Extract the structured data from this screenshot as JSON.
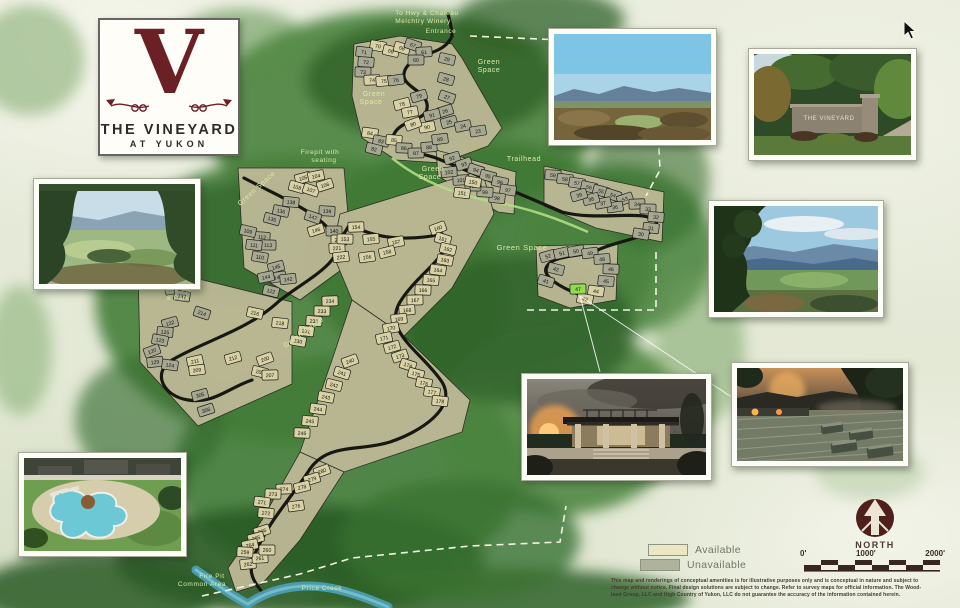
{
  "logo": {
    "letter": "V",
    "line1": "THE VINEYARD",
    "line2": "AT YUKON"
  },
  "photos": {
    "entrance_sign_text": "THE VINEYARD"
  },
  "map": {
    "labels": [
      {
        "t": "To Hwy & Chateau",
        "x": 427,
        "y": 15,
        "s": 6.5
      },
      {
        "t": "Melchtry Winery",
        "x": 423,
        "y": 23,
        "s": 6.5
      },
      {
        "t": "Entrance",
        "x": 441,
        "y": 33,
        "s": 6.5
      },
      {
        "t": "Green",
        "x": 489,
        "y": 64,
        "s": 7
      },
      {
        "t": "Space",
        "x": 489,
        "y": 72,
        "s": 7
      },
      {
        "t": "Green",
        "x": 374,
        "y": 96,
        "s": 7
      },
      {
        "t": "Space",
        "x": 371,
        "y": 104,
        "s": 7
      },
      {
        "t": "Firepit with",
        "x": 320,
        "y": 154,
        "s": 6.5
      },
      {
        "t": "seating",
        "x": 324,
        "y": 162,
        "s": 6.5
      },
      {
        "t": "Green",
        "x": 433,
        "y": 171,
        "s": 7
      },
      {
        "t": "Space",
        "x": 430,
        "y": 179,
        "s": 7
      },
      {
        "t": "Trailhead",
        "x": 524,
        "y": 161,
        "s": 7
      },
      {
        "t": "Green Space",
        "x": 522,
        "y": 250,
        "s": 7.5
      },
      {
        "t": "Green Space",
        "x": 258,
        "y": 190,
        "s": 7,
        "r": -42
      },
      {
        "t": "Green Space",
        "x": 305,
        "y": 334,
        "s": 7,
        "r": -36
      },
      {
        "t": "Fire Pit",
        "x": 178,
        "y": 292,
        "s": 6.5
      },
      {
        "t": "& Park",
        "x": 178,
        "y": 300,
        "s": 6.5
      },
      {
        "t": "Fire Pit",
        "x": 212,
        "y": 578,
        "s": 6.5
      },
      {
        "t": "Common Area",
        "x": 202,
        "y": 586,
        "s": 6.5
      },
      {
        "t": "Price Creek",
        "x": 322,
        "y": 590,
        "s": 6.5
      }
    ],
    "lot_colors": {
      "t": "#d8d1a6",
      "g": "#a7a892",
      "h": "#8fdc4e"
    },
    "lots": [
      [
        70,
        378,
        46,
        "t"
      ],
      [
        71,
        364,
        52,
        "g"
      ],
      [
        72,
        366,
        62,
        "g"
      ],
      [
        73,
        363,
        72,
        "g"
      ],
      [
        74,
        372,
        80,
        "t"
      ],
      [
        75,
        384,
        81,
        "t"
      ],
      [
        76,
        396,
        80,
        "g"
      ],
      [
        69,
        391,
        51,
        "t"
      ],
      [
        68,
        402,
        48,
        "t"
      ],
      [
        67,
        413,
        45,
        "g"
      ],
      [
        61,
        424,
        52,
        "g"
      ],
      [
        60,
        416,
        60,
        "g"
      ],
      [
        29,
        447,
        59,
        "g"
      ],
      [
        28,
        446,
        79,
        "g"
      ],
      [
        27,
        447,
        97,
        "g"
      ],
      [
        26,
        445,
        111,
        "g"
      ],
      [
        25,
        449,
        122,
        "g"
      ],
      [
        24,
        463,
        126,
        "g"
      ],
      [
        23,
        478,
        131,
        "g"
      ],
      [
        79,
        419,
        96,
        "g"
      ],
      [
        78,
        402,
        104,
        "t"
      ],
      [
        77,
        410,
        112,
        "t"
      ],
      [
        91,
        432,
        115,
        "g"
      ],
      [
        90,
        427,
        127,
        "t"
      ],
      [
        80,
        413,
        124,
        "t"
      ],
      [
        84,
        370,
        133,
        "t"
      ],
      [
        83,
        381,
        141,
        "g"
      ],
      [
        82,
        374,
        149,
        "g"
      ],
      [
        85,
        394,
        140,
        "t"
      ],
      [
        86,
        404,
        148,
        "g"
      ],
      [
        87,
        416,
        153,
        "g"
      ],
      [
        88,
        429,
        147,
        "g"
      ],
      [
        89,
        440,
        139,
        "g"
      ],
      [
        92,
        452,
        158,
        "g"
      ],
      [
        93,
        464,
        164,
        "g"
      ],
      [
        94,
        476,
        170,
        "g"
      ],
      [
        95,
        488,
        176,
        "g"
      ],
      [
        96,
        500,
        182,
        "g"
      ],
      [
        97,
        508,
        190,
        "g"
      ],
      [
        98,
        497,
        198,
        "g"
      ],
      [
        99,
        485,
        192,
        "g"
      ],
      [
        100,
        473,
        186,
        "g"
      ],
      [
        101,
        461,
        180,
        "g"
      ],
      [
        102,
        449,
        172,
        "g"
      ],
      [
        59,
        553,
        175,
        "g"
      ],
      [
        58,
        565,
        179,
        "g"
      ],
      [
        57,
        577,
        183,
        "g"
      ],
      [
        56,
        589,
        187,
        "g"
      ],
      [
        55,
        601,
        191,
        "g"
      ],
      [
        54,
        613,
        195,
        "g"
      ],
      [
        53,
        625,
        199,
        "g"
      ],
      [
        34,
        637,
        204,
        "g"
      ],
      [
        33,
        648,
        209,
        "g"
      ],
      [
        32,
        656,
        217,
        "g"
      ],
      [
        31,
        651,
        228,
        "g"
      ],
      [
        30,
        641,
        234,
        "g"
      ],
      [
        36,
        615,
        207,
        "g"
      ],
      [
        37,
        603,
        203,
        "g"
      ],
      [
        38,
        591,
        199,
        "g"
      ],
      [
        39,
        579,
        195,
        "g"
      ],
      [
        52,
        548,
        256,
        "g"
      ],
      [
        51,
        562,
        253,
        "g"
      ],
      [
        50,
        576,
        251,
        "g"
      ],
      [
        49,
        590,
        253,
        "g"
      ],
      [
        48,
        602,
        259,
        "g"
      ],
      [
        46,
        611,
        269,
        "g"
      ],
      [
        45,
        606,
        281,
        "g"
      ],
      [
        44,
        596,
        291,
        "t"
      ],
      [
        43,
        585,
        299,
        "t"
      ],
      [
        42,
        556,
        269,
        "g"
      ],
      [
        41,
        546,
        281,
        "g"
      ],
      [
        47,
        578,
        289,
        "h"
      ],
      [
        105,
        303,
        178,
        "t"
      ],
      [
        104,
        316,
        176,
        "t"
      ],
      [
        108,
        297,
        187,
        "t"
      ],
      [
        107,
        311,
        190,
        "t"
      ],
      [
        106,
        325,
        185,
        "t"
      ],
      [
        138,
        291,
        202,
        "g"
      ],
      [
        139,
        327,
        211,
        "g"
      ],
      [
        147,
        313,
        217,
        "g"
      ],
      [
        146,
        316,
        230,
        "t"
      ],
      [
        140,
        334,
        231,
        "g"
      ],
      [
        220,
        339,
        240,
        "t"
      ],
      [
        221,
        337,
        248,
        "t"
      ],
      [
        222,
        341,
        257,
        "t"
      ],
      [
        136,
        281,
        211,
        "g"
      ],
      [
        135,
        272,
        219,
        "g"
      ],
      [
        112,
        262,
        237,
        "g"
      ],
      [
        113,
        268,
        245,
        "g"
      ],
      [
        111,
        254,
        245,
        "g"
      ],
      [
        110,
        260,
        257,
        "g"
      ],
      [
        109,
        248,
        231,
        "g"
      ],
      [
        145,
        276,
        267,
        "g"
      ],
      [
        143,
        278,
        277,
        "g"
      ],
      [
        142,
        288,
        279,
        "g"
      ],
      [
        144,
        266,
        277,
        "g"
      ],
      [
        122,
        271,
        291,
        "g"
      ],
      [
        117,
        169,
        277,
        "t"
      ],
      [
        134,
        177,
        278,
        "g"
      ],
      [
        130,
        173,
        289,
        "g"
      ],
      [
        137,
        182,
        296,
        "g"
      ],
      [
        214,
        202,
        313,
        "g"
      ],
      [
        216,
        255,
        313,
        "t"
      ],
      [
        218,
        280,
        323,
        "t"
      ],
      [
        132,
        170,
        323,
        "g"
      ],
      [
        125,
        165,
        332,
        "g"
      ],
      [
        123,
        160,
        340,
        "g"
      ],
      [
        120,
        152,
        351,
        "g"
      ],
      [
        129,
        155,
        362,
        "g"
      ],
      [
        124,
        170,
        365,
        "g"
      ],
      [
        211,
        195,
        361,
        "t"
      ],
      [
        209,
        197,
        370,
        "t"
      ],
      [
        212,
        233,
        358,
        "t"
      ],
      [
        200,
        265,
        359,
        "t"
      ],
      [
        202,
        260,
        372,
        "t"
      ],
      [
        207,
        270,
        375,
        "t"
      ],
      [
        305,
        200,
        395,
        "g"
      ],
      [
        306,
        206,
        410,
        "g"
      ],
      [
        154,
        356,
        227,
        "t"
      ],
      [
        155,
        371,
        239,
        "t"
      ],
      [
        157,
        396,
        242,
        "t"
      ],
      [
        158,
        387,
        252,
        "t"
      ],
      [
        156,
        367,
        257,
        "t"
      ],
      [
        153,
        345,
        239,
        "t"
      ],
      [
        150,
        473,
        182,
        "t"
      ],
      [
        151,
        462,
        193,
        "t"
      ],
      [
        160,
        438,
        228,
        "t"
      ],
      [
        161,
        443,
        239,
        "t"
      ],
      [
        162,
        448,
        249,
        "t"
      ],
      [
        163,
        445,
        260,
        "t"
      ],
      [
        164,
        438,
        270,
        "t"
      ],
      [
        165,
        431,
        280,
        "t"
      ],
      [
        166,
        423,
        290,
        "t"
      ],
      [
        167,
        415,
        300,
        "t"
      ],
      [
        168,
        407,
        310,
        "t"
      ],
      [
        169,
        399,
        319,
        "t"
      ],
      [
        170,
        391,
        328,
        "t"
      ],
      [
        171,
        384,
        338,
        "t"
      ],
      [
        172,
        392,
        347,
        "t"
      ],
      [
        173,
        400,
        356,
        "t"
      ],
      [
        174,
        408,
        365,
        "t"
      ],
      [
        175,
        416,
        374,
        "t"
      ],
      [
        176,
        424,
        383,
        "t"
      ],
      [
        177,
        432,
        392,
        "t"
      ],
      [
        178,
        440,
        401,
        "t"
      ],
      [
        234,
        330,
        301,
        "t"
      ],
      [
        233,
        322,
        311,
        "t"
      ],
      [
        232,
        314,
        321,
        "t"
      ],
      [
        231,
        306,
        331,
        "t"
      ],
      [
        230,
        298,
        341,
        "t"
      ],
      [
        240,
        350,
        361,
        "t"
      ],
      [
        241,
        342,
        373,
        "t"
      ],
      [
        242,
        334,
        385,
        "t"
      ],
      [
        243,
        326,
        397,
        "t"
      ],
      [
        244,
        318,
        409,
        "t"
      ],
      [
        245,
        310,
        421,
        "t"
      ],
      [
        246,
        302,
        433,
        "t"
      ],
      [
        280,
        322,
        471,
        "t"
      ],
      [
        279,
        312,
        479,
        "t"
      ],
      [
        278,
        302,
        487,
        "t"
      ],
      [
        274,
        284,
        489,
        "t"
      ],
      [
        273,
        273,
        494,
        "t"
      ],
      [
        276,
        296,
        506,
        "t"
      ],
      [
        272,
        266,
        513,
        "t"
      ],
      [
        271,
        262,
        502,
        "t"
      ],
      [
        266,
        262,
        531,
        "t"
      ],
      [
        265,
        256,
        538,
        "t"
      ],
      [
        264,
        250,
        545,
        "t"
      ],
      [
        262,
        248,
        564,
        "t"
      ],
      [
        261,
        260,
        558,
        "t"
      ],
      [
        260,
        267,
        550,
        "t"
      ],
      [
        259,
        245,
        552,
        "t"
      ]
    ],
    "legend": {
      "items": [
        {
          "label": "Available",
          "color": "#ebe7c3"
        },
        {
          "label": "Unavailable",
          "color": "#aeb49b"
        }
      ]
    },
    "compass_label": "NORTH",
    "scale_ticks": [
      "0'",
      "1000'",
      "2000'"
    ],
    "disclaimer_lines": [
      "This map and renderings of conceptual amenities is for illustrative purposes only and is conceptual in nature and subject to",
      "change without notice. Final design solutions are subject to change. Refer to survey maps for official information. The Wood-",
      "land Group, LLC and High Country of Yukon, LLC  do not guarantee the accuracy of the information contained herein."
    ]
  }
}
